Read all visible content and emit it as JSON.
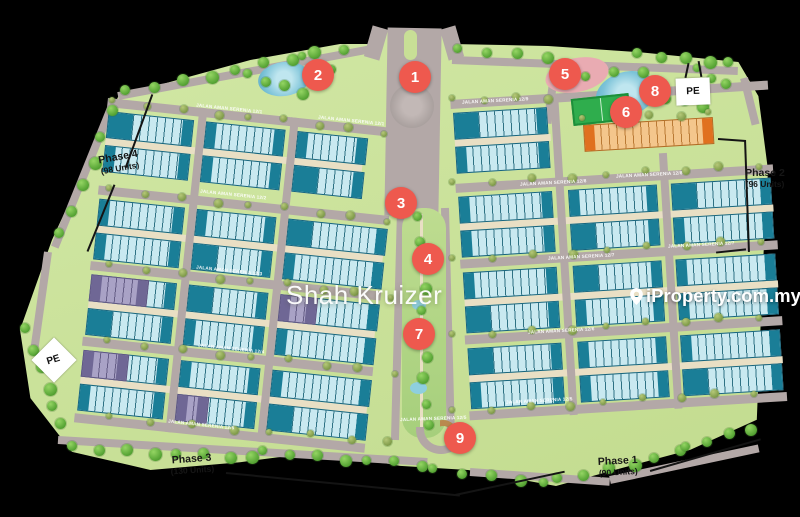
{
  "watermarks": {
    "center": "Shah Kruizer",
    "right": "iProperty.com.my"
  },
  "pe": {
    "label": "PE"
  },
  "markers": [
    {
      "label": "1"
    },
    {
      "label": "2"
    },
    {
      "label": "3"
    },
    {
      "label": "4"
    },
    {
      "label": "5"
    },
    {
      "label": "6"
    },
    {
      "label": "7"
    },
    {
      "label": "8"
    },
    {
      "label": "9"
    }
  ],
  "roads": [
    {
      "label": "JALAN AMAN SERENIA 12/1"
    },
    {
      "label": "JALAN AMAN SERENIA 12/1"
    },
    {
      "label": "JALAN AMAN SERENIA 12/2"
    },
    {
      "label": "JALAN AMAN SERENIA 12/3"
    },
    {
      "label": "JALAN AMAN SERENIA 12/4"
    },
    {
      "label": "JALAN AMAN SERENIA 12/5"
    },
    {
      "label": "JALAN AMAN SERENIA 12/9"
    },
    {
      "label": "JALAN AMAN SERENIA 12/8"
    },
    {
      "label": "JALAN AMAN SERENIA 12/8"
    },
    {
      "label": "JALAN AMAN SERENIA 12/7"
    },
    {
      "label": "JALAN AMAN SERENIA 12/7"
    },
    {
      "label": "JALAN AMAN SERENIA 12/6"
    },
    {
      "label": "JALAN AMAN SERENIA 12/5"
    },
    {
      "label": "JALAN AMAN SERENIA 12/5"
    }
  ],
  "phases": {
    "p1": {
      "name": "Phase 1",
      "units": "(90 Units)"
    },
    "p2": {
      "name": "Phase 2",
      "units": "(96 Units)"
    },
    "p3": {
      "name": "Phase 3",
      "units": "(130 Units)"
    },
    "p4": {
      "name": "Phase 4",
      "units": "(98 Units)"
    }
  },
  "amenities": [
    {
      "name": "playground"
    },
    {
      "name": "basketball-court"
    },
    {
      "name": "lagoon"
    },
    {
      "name": "pond"
    },
    {
      "name": "linear-park"
    }
  ],
  "colors": {
    "marker_red": "#ee594e",
    "house_teal_dark": "#1a7e97",
    "house_teal_light": "#c9e9f0",
    "house_purple": "#a9a2c6",
    "shop_orange": "#e0701f",
    "road_grey": "#b3a8a7",
    "site_green": "#c8df96"
  }
}
